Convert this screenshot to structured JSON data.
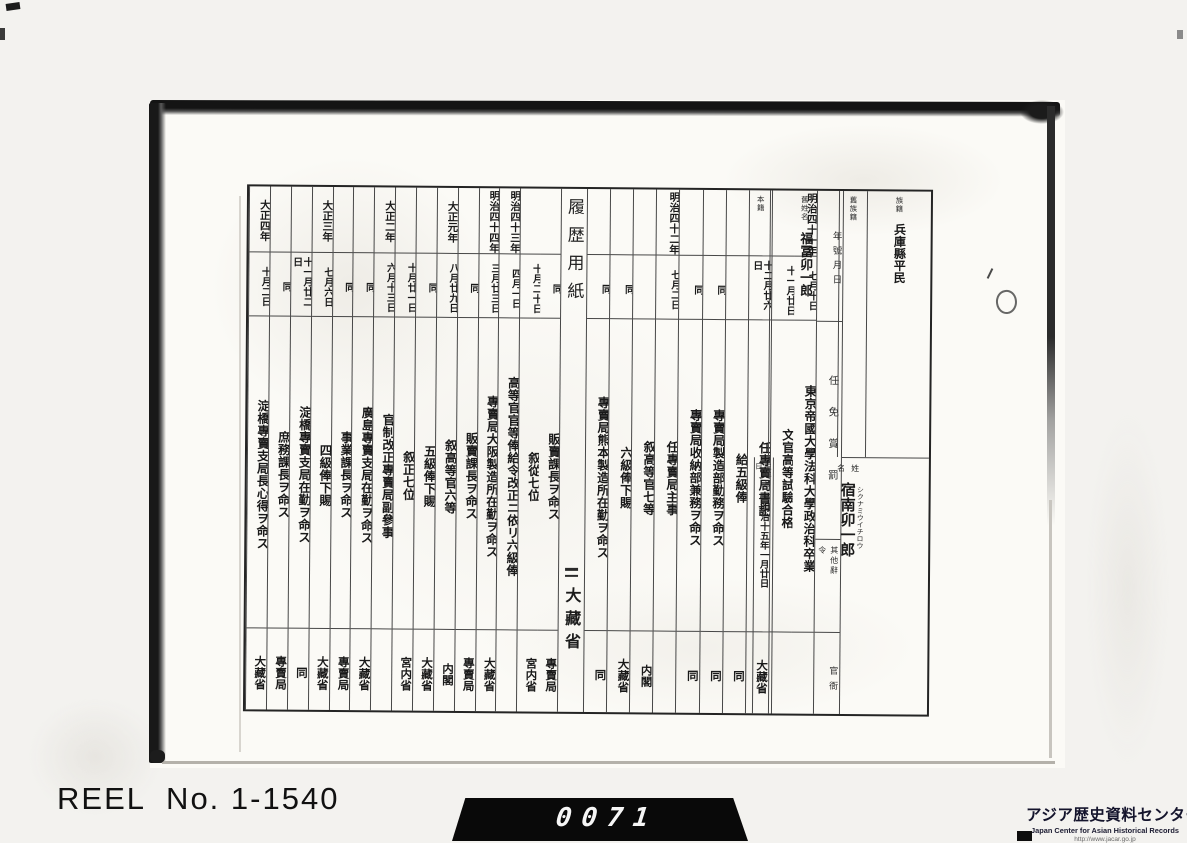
{
  "reel": {
    "label": "REEL  No. 1-1540"
  },
  "counter": {
    "digits": "0071"
  },
  "logo": {
    "jp": "アジア歴史資料センター",
    "en": "Japan Center for Asian Historical Records",
    "url": "http://www.jacar.go.jp"
  },
  "form": {
    "title": "履歴用紙",
    "ministry": "大藏省",
    "headers": {
      "zokuseki": "族籍",
      "kyu_zokuseki": "舊族籍",
      "kyu_seimei": "舊姓名",
      "honseki": "本籍",
      "date_col": "年號月日",
      "action_col": "任免賞罰",
      "other_col": "其他辭令",
      "office_col": "官衙",
      "seimei": "姓名",
      "birth": "生年月日"
    },
    "person": {
      "zokuseki": "兵庫縣平民",
      "kyu_zokuseki": "",
      "kyu_seimei": "福冨卯一郎",
      "honseki": "",
      "name": "宿南卯一郎",
      "name_furigana": "シクナミウイチロウ",
      "birth_date": "明治十五年一月廿日"
    },
    "split_index": 10,
    "entries": [
      {
        "year": "明治四十一年",
        "day": "七月十日",
        "action": "東京帝國大學法科大學政治科卒業",
        "office": ""
      },
      {
        "year": "",
        "day": "十一月廿日",
        "action": "文官高等試驗合格",
        "office": ""
      },
      {
        "year": "",
        "day": "十二月廿六日",
        "action": "任專賣局書記",
        "office": "大藏省"
      },
      {
        "year": "",
        "day": "",
        "action": "給五級俸",
        "office": "同"
      },
      {
        "year": "",
        "day": "同",
        "action": "專賣局製造部勤務ヲ命ス",
        "office": "同"
      },
      {
        "year": "",
        "day": "同",
        "action": "專賣局收納部兼務ヲ命ス",
        "office": "同"
      },
      {
        "year": "明治四十二年",
        "day": "七月二日",
        "action": "任專賣局主事",
        "office": ""
      },
      {
        "year": "",
        "day": "",
        "action": "叙高等官七等",
        "office": "内閣"
      },
      {
        "year": "",
        "day": "同",
        "action": "六級俸下賜",
        "office": "大藏省"
      },
      {
        "year": "",
        "day": "同",
        "action": "專賣局熊本製造所在勤ヲ命ス",
        "office": "同"
      },
      {
        "year": "",
        "day": "同",
        "action": "販賣課長ヲ命ス",
        "office": "專賣局"
      },
      {
        "year": "",
        "day": "十月二十日",
        "action": "叙從七位",
        "office": "宮内省"
      },
      {
        "year": "明治四十三年",
        "day": "四月一日",
        "action": "高等官官等俸給令改正ニ依リ六級俸",
        "office": ""
      },
      {
        "year": "明治四十四年",
        "day": "三月廿三日",
        "action": "專賣局大阪製造所在勤ヲ命ス",
        "office": "大藏省"
      },
      {
        "year": "",
        "day": "同",
        "action": "販賣課長ヲ命ス",
        "office": "專賣局"
      },
      {
        "year": "大正元年",
        "day": "八月廿九日",
        "action": "叙高等官六等",
        "office": "内閣"
      },
      {
        "year": "",
        "day": "同",
        "action": "五級俸下賜",
        "office": "大藏省"
      },
      {
        "year": "",
        "day": "十月廿一日",
        "action": "叙正七位",
        "office": "宮内省"
      },
      {
        "year": "大正二年",
        "day": "六月十三日",
        "action": "官制改正專賣局副參事",
        "office": ""
      },
      {
        "year": "",
        "day": "同",
        "action": "廣島專賣支局在勤ヲ命ス",
        "office": "大藏省"
      },
      {
        "year": "",
        "day": "同",
        "action": "事業課長ヲ命ス",
        "office": "專賣局"
      },
      {
        "year": "大正三年",
        "day": "七月六日",
        "action": "四級俸下賜",
        "office": "大藏省"
      },
      {
        "year": "",
        "day": "十一月廿二日",
        "action": "淀橋專賣支局在勤ヲ命ス",
        "office": "同"
      },
      {
        "year": "",
        "day": "同",
        "action": "庶務課長ヲ命ス",
        "office": "專賣局"
      },
      {
        "year": "大正四年",
        "day": "十月二日",
        "action": "淀橋專賣支局長心得ヲ命ス",
        "office": "大藏省"
      }
    ]
  }
}
